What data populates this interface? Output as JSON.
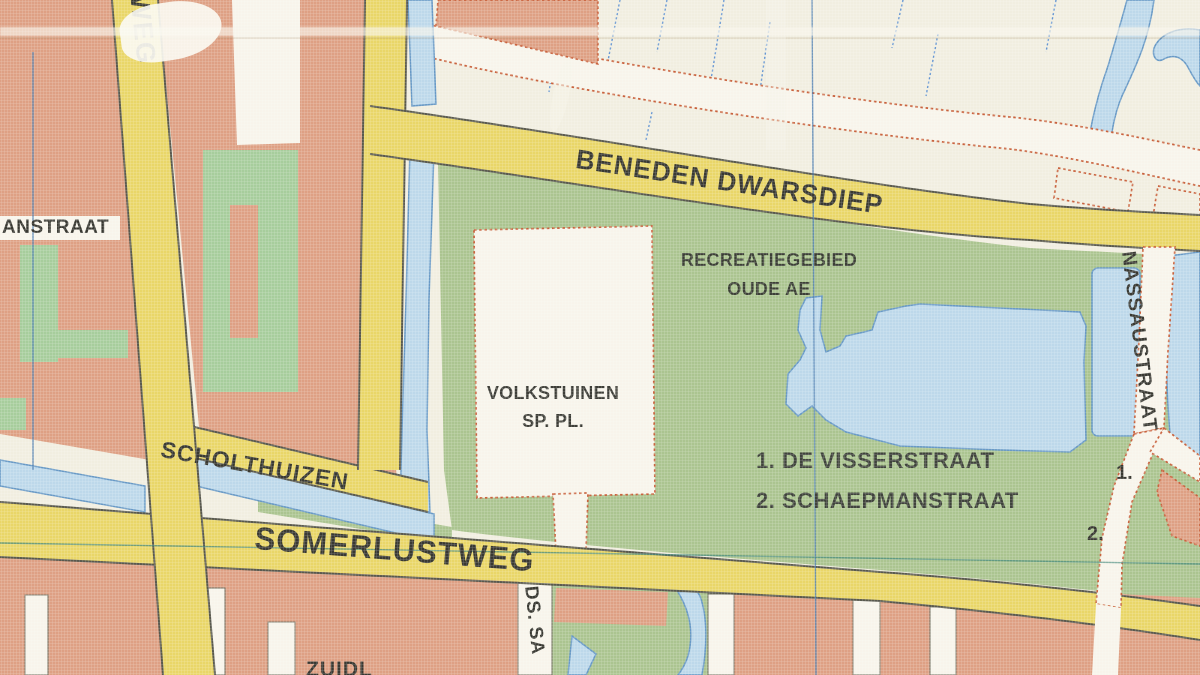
{
  "map": {
    "labels": {
      "road_partial_top_left": "NWEG",
      "street_partial_left": "ANSTRAAT",
      "road_main": "BENEDEN DWARSDIEP",
      "recreation_area_line1": "RECREATIEGEBIED",
      "recreation_area_line2": "OUDE AE",
      "allotments_line1": "VOLKSTUINEN",
      "allotments_line2": "SP. PL.",
      "road_scholthuizen": "SCHOLTHUIZEN",
      "road_somerlustweg": "SOMERLUSTWEG",
      "street_list_item1": "1. DE VISSERSTRAAT",
      "street_list_item2": "2. SCHAEPMANSTRAAT",
      "street_nassaustraat": "NASSAUSTRAAT",
      "marker_1": "1.",
      "marker_2": "2.",
      "street_partial_bottom_center": "DS. SA",
      "street_partial_bottom_left": "ZUIDL"
    },
    "colors": {
      "cream": "#f0edde",
      "salmon": "#dc9b7d",
      "road_yellow": "#e8d45f",
      "green": "#a6c189",
      "green2": "#a2ca96",
      "water_blue": "#b9d6e9",
      "water_edge": "#5f93c2",
      "street_white": "#f7f4ea",
      "road_edge": "#4f4f44",
      "dotted_red": "#c65a33",
      "ink": "#2d2d26",
      "grid_blue": "#4a7cb0",
      "grid_teal": "#3f8577"
    }
  }
}
